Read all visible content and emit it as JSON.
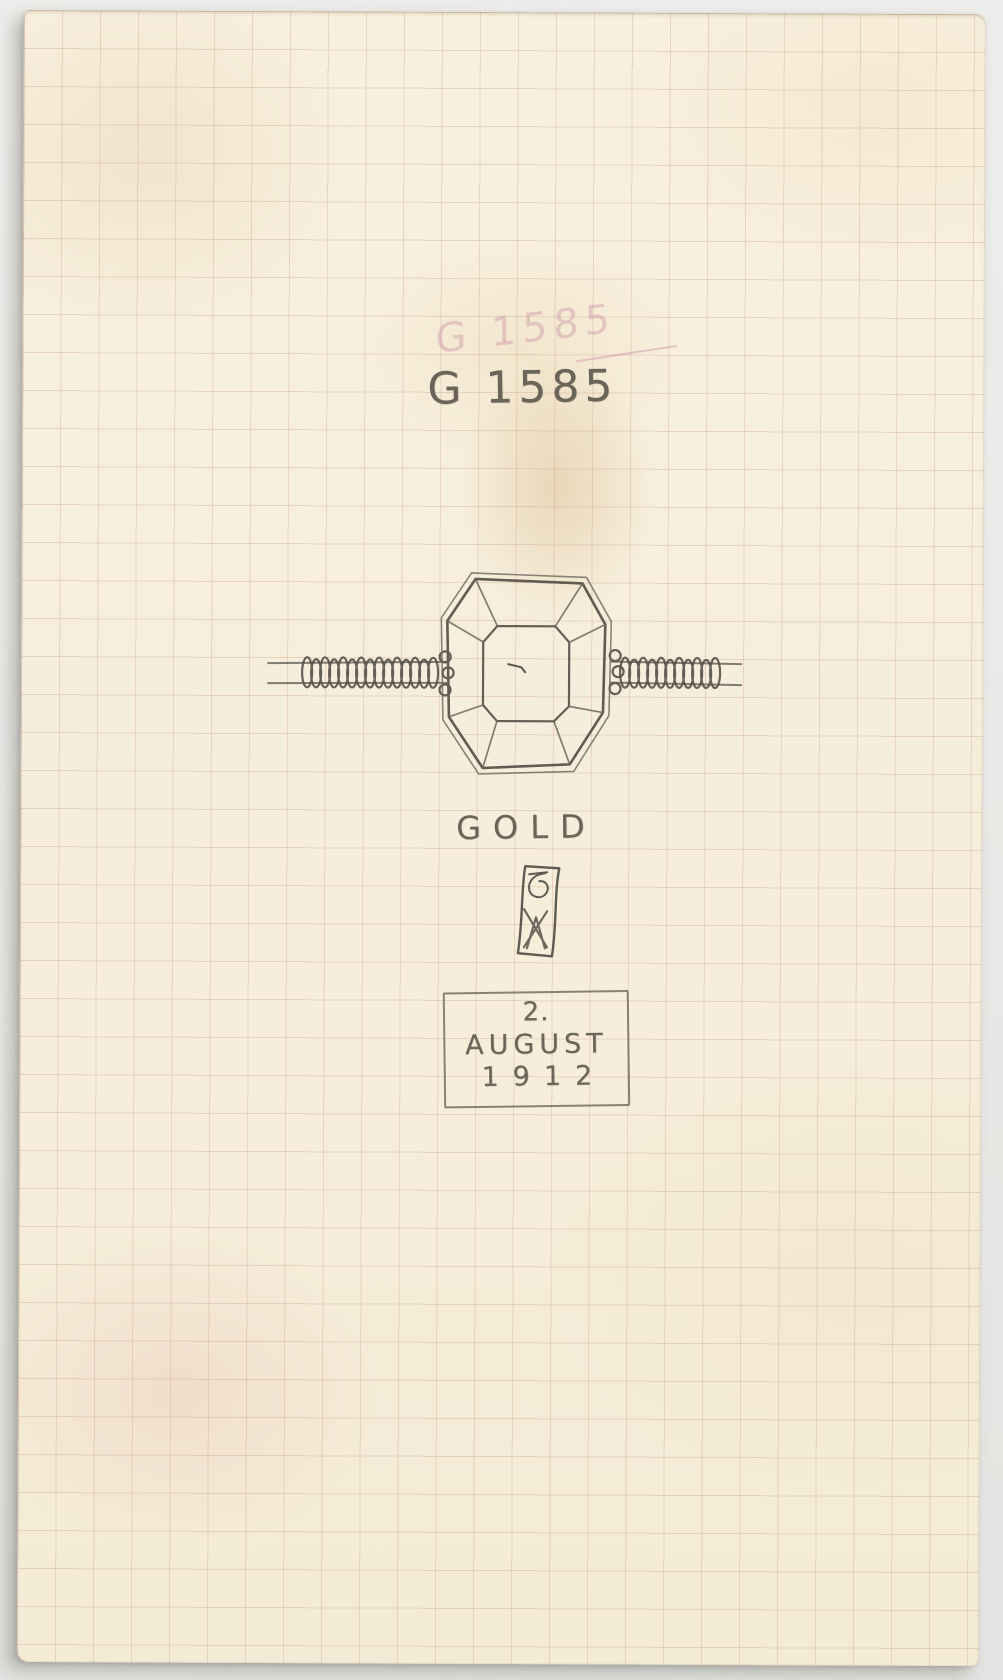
{
  "artifact": {
    "catalog_number": "G 1585",
    "catalog_number_ghost": "G 1585",
    "material": "GOLD",
    "date": {
      "day": "2.",
      "month": "AUGUST",
      "year": "1912"
    }
  },
  "sketches": {
    "bracelet": "coiled-spring-band-with-emerald-cut-stone",
    "monogram": "boxed-monogram-mark"
  },
  "colors": {
    "backdrop": "#e9eae7",
    "paper": "#f7efdd",
    "grid": "#cb9285",
    "pencil": "#6b6459",
    "ghost": "#c27e9a"
  }
}
